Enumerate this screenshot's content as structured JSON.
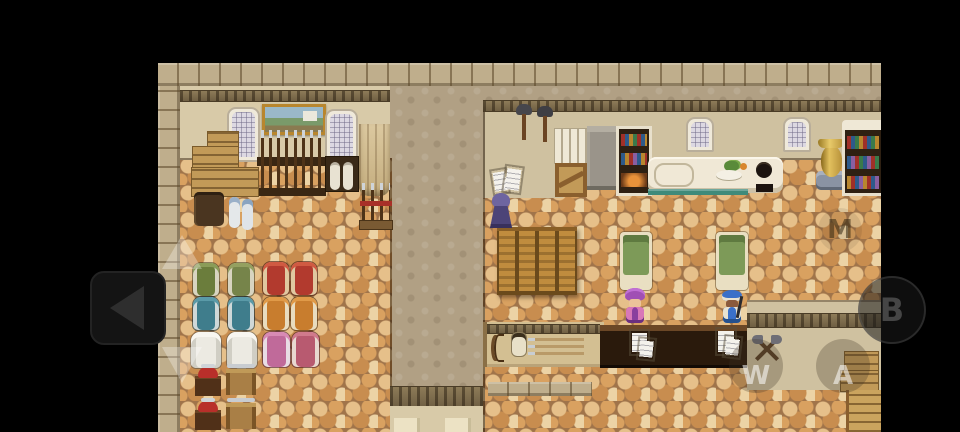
{
  "window": {
    "title": "RPG shop and inn interior (mobile touch overlay)",
    "width": 960,
    "height": 432
  },
  "palette": {
    "bg": "#000000",
    "path": "#b1a084",
    "stone": "#bfae8c",
    "wallA": "#d8caa8",
    "wallB": "#cfc1a0",
    "cobbleBase": "#a0744a",
    "cobble1": "#e6c08a",
    "cobble2": "#d9a160",
    "cobble3": "#c88d4f",
    "cobble4": "#ecd3a5",
    "counterCream": "#f0e8d6",
    "counterDark": "#2a1a0c",
    "wood": "#c29a58",
    "woodDark": "#6b4423",
    "bedGreen": "#7d9a58",
    "screenWood": "#c08c3e",
    "vaseGold": "#cfa23e",
    "teal": "#3f8a7a"
  },
  "overlay": {
    "dpad": {
      "up_icon": "up-arrow",
      "left_icon": "left-arrow",
      "down_icon": "down-arrow"
    },
    "buttons": [
      {
        "id": "m",
        "label": "M"
      },
      {
        "id": "b",
        "label": "B"
      },
      {
        "id": "w",
        "label": "W"
      },
      {
        "id": "a",
        "label": "A"
      }
    ]
  },
  "scene": {
    "characters": [
      {
        "name": "hooded-figure",
        "color": "#4c4478"
      },
      {
        "name": "purple-turban-merchant",
        "color": "#8a3f9e"
      },
      {
        "name": "blue-cap-clerk",
        "color": "#3a70c8"
      }
    ],
    "notable_objects": [
      "framed-painting",
      "weapon-racks",
      "armor-floor-displays",
      "crates",
      "barrel",
      "towel-rolls",
      "display-tables",
      "wall-hammers",
      "folding-screen",
      "beds",
      "kitchen-counter",
      "stove",
      "golden-vase",
      "bookshelves",
      "crossed-axes-sign",
      "archery-table",
      "service-counter",
      "wall-papers",
      "windows"
    ]
  }
}
